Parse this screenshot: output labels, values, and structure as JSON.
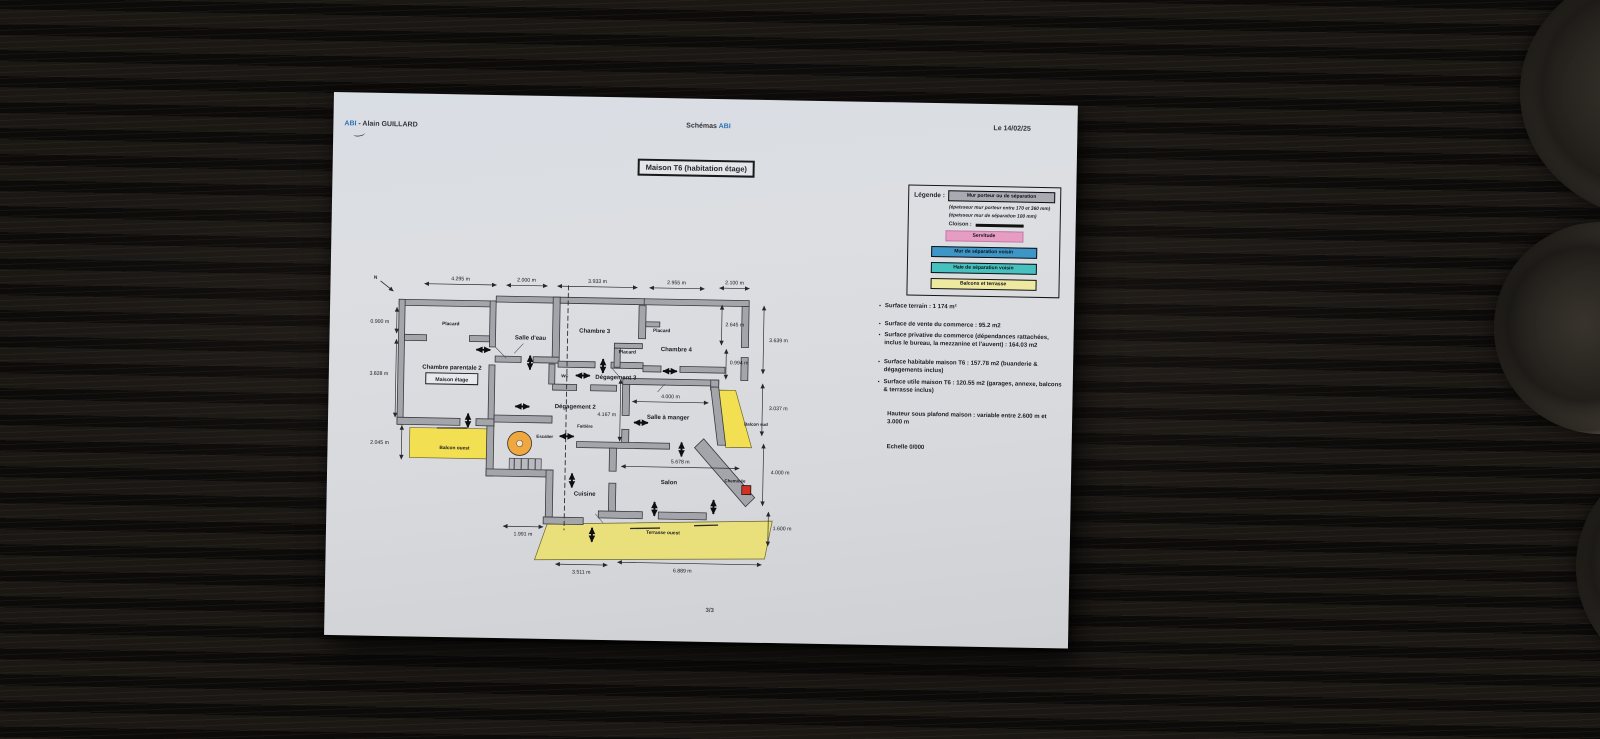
{
  "header": {
    "author_brand": "ABI",
    "author_rest": " - Alain GUILLARD",
    "center_prefix": "Schémas ",
    "center_brand": "ABI",
    "date": "Le 14/02/25",
    "title": "Maison T6 (habitation étage)"
  },
  "legend": {
    "title": "Légende :",
    "wall_swatch": "Mur porteur ou de séparation",
    "note1": "(épaisseur mur porteur entre 170 et 360 mm)",
    "note2": "(épaisseur mur de séparation 100 mm)",
    "cloison_label": "Cloison :",
    "items": [
      {
        "label": "Servitude",
        "color": "#e79dc3"
      },
      {
        "label": "Mur de séparation voisin",
        "color": "#3d96c6"
      },
      {
        "label": "Haie de séparation voisin",
        "color": "#46c1bf"
      },
      {
        "label": "Balcons et terrasse",
        "color": "#eee9a0"
      }
    ],
    "wall_color": "#a9abb2"
  },
  "notes": {
    "bullets": [
      "Surface terrain : 1 174 m²",
      "Surface de vente du commerce : 95.2 m2",
      "Surface privative du commerce (dépendances rattachées, inclus le bureau, la mezzanine et l'auvent) : 164.03 m2",
      "Surface habitable maison T6 : 157.78 m2 (buanderie & dégagements inclus)",
      "Surface utile maison T6 : 120.55 m2 (garages, annexe, balcons & terrasse inclus)"
    ],
    "ceiling": "Hauteur sous plafond maison : variable entre 2.600 m et 3.000 m",
    "scale": "Echelle 0/000"
  },
  "plan": {
    "labels": {
      "north": "N",
      "placard": "Placard",
      "chambre_parentale": "Chambre parentale 2",
      "maison_etage": "Maison étage",
      "salle_deau": "Salle d'eau",
      "chambre3": "Chambre 3",
      "chambre4": "Chambre 4",
      "wc": "wc",
      "degagement3": "Dégagement 3",
      "degagement2": "Dégagement 2",
      "salle_a_manger": "Salle à manger",
      "faitiere": "Faitière",
      "escalier": "Escalier",
      "cuisine": "Cuisine",
      "salon": "Salon",
      "cheminee": "Cheminée",
      "balcon_ouest": "Balcon ouest",
      "balcon_sud": "Balcon sud",
      "terrasse_ouest": "Terrasse ouest"
    },
    "dims": {
      "top": [
        "4.295 m",
        "2.000 m",
        "3.933 m",
        "2.955 m",
        "2.100 m"
      ],
      "left": [
        "0.900 m",
        "3.828 m",
        "2.045 m"
      ],
      "right": [
        "2.645 m",
        "3.639 m",
        "0.994 m",
        "3.037 m",
        "4.000 m",
        "1.600 m"
      ],
      "bottom": [
        "1.991 m",
        "3.511 m",
        "6.889 m"
      ],
      "inner": [
        "4.000 m",
        "4.167 m",
        "5.678 m"
      ]
    }
  },
  "footer": {
    "page": "3/3"
  }
}
